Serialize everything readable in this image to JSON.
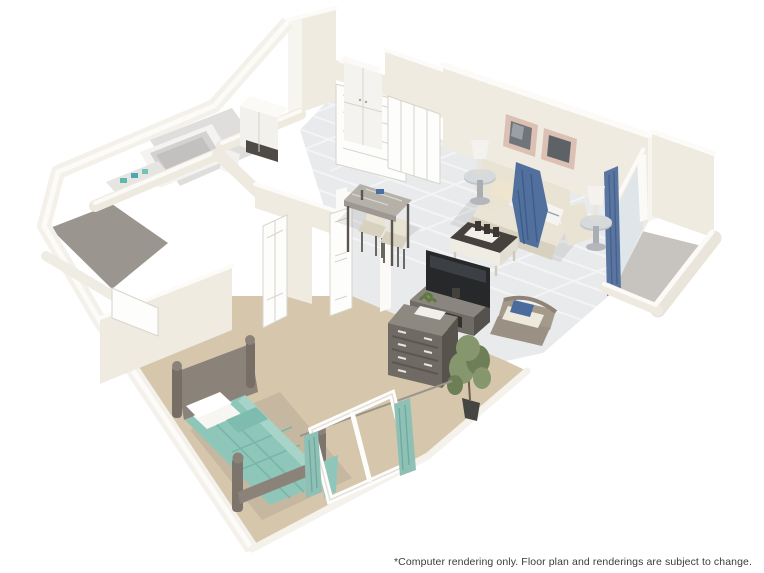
{
  "image": {
    "title": "3D apartment floor plan rendering",
    "projection": "isometric cutaway, viewed from above"
  },
  "footer": {
    "disclaimer": "*Computer rendering only. Floor plan and renderings are subject to change."
  },
  "floorplan": {
    "rooms": [
      {
        "name": "entry-hall",
        "objects": [
          "front-door",
          "pantry-cabinet",
          "bifold-coat-closet"
        ]
      },
      {
        "name": "kitchen",
        "objects": [
          "white-appliance",
          "counter"
        ]
      },
      {
        "name": "bathroom",
        "objects": [
          "bathtub",
          "toilet",
          "vanity-with-teal-accessories"
        ]
      },
      {
        "name": "walk-in-closet",
        "objects": [
          "gray-carpet",
          "closet-door"
        ]
      },
      {
        "name": "living-room",
        "objects": [
          "sofa",
          "blue-throw-blanket",
          "accent-pillows",
          "two-side-tables",
          "two-table-lamps",
          "coffee-table-with-candles",
          "two-wall-art-frames",
          "tv",
          "media-console",
          "wicker-chair",
          "tall-potted-plant"
        ]
      },
      {
        "name": "dining-nook",
        "objects": [
          "marble-bar-table",
          "two-chairs"
        ]
      },
      {
        "name": "bedroom",
        "objects": [
          "bed-with-teal-duvet",
          "headboard",
          "footboard",
          "dresser",
          "window-with-teal-curtains",
          "angled-closet",
          "bedroom-door"
        ]
      },
      {
        "name": "balcony",
        "objects": [
          "sliding-glass-door",
          "blue-curtain-panel",
          "concrete-floor"
        ]
      }
    ],
    "colors": {
      "background": "#ffffff",
      "wall": "#efebe1",
      "wall_top": "#fcfbf8",
      "tile_floor": "#e9eaec",
      "carpet": "#d6c7ac",
      "closet_carpet": "#9a958e",
      "balcony_floor": "#c7c4c0",
      "bed_duvet": "#8fc6ba",
      "curtain_teal": "#8fc0b5",
      "throw_blue": "#51709e",
      "curtain_blue": "#5a75a0",
      "sofa": "#eae4d6",
      "marble": "#b5b1a9",
      "tv_screen": "#26282a",
      "frame_pink": "#dcc0b4",
      "text": "#3b3b3b"
    }
  }
}
